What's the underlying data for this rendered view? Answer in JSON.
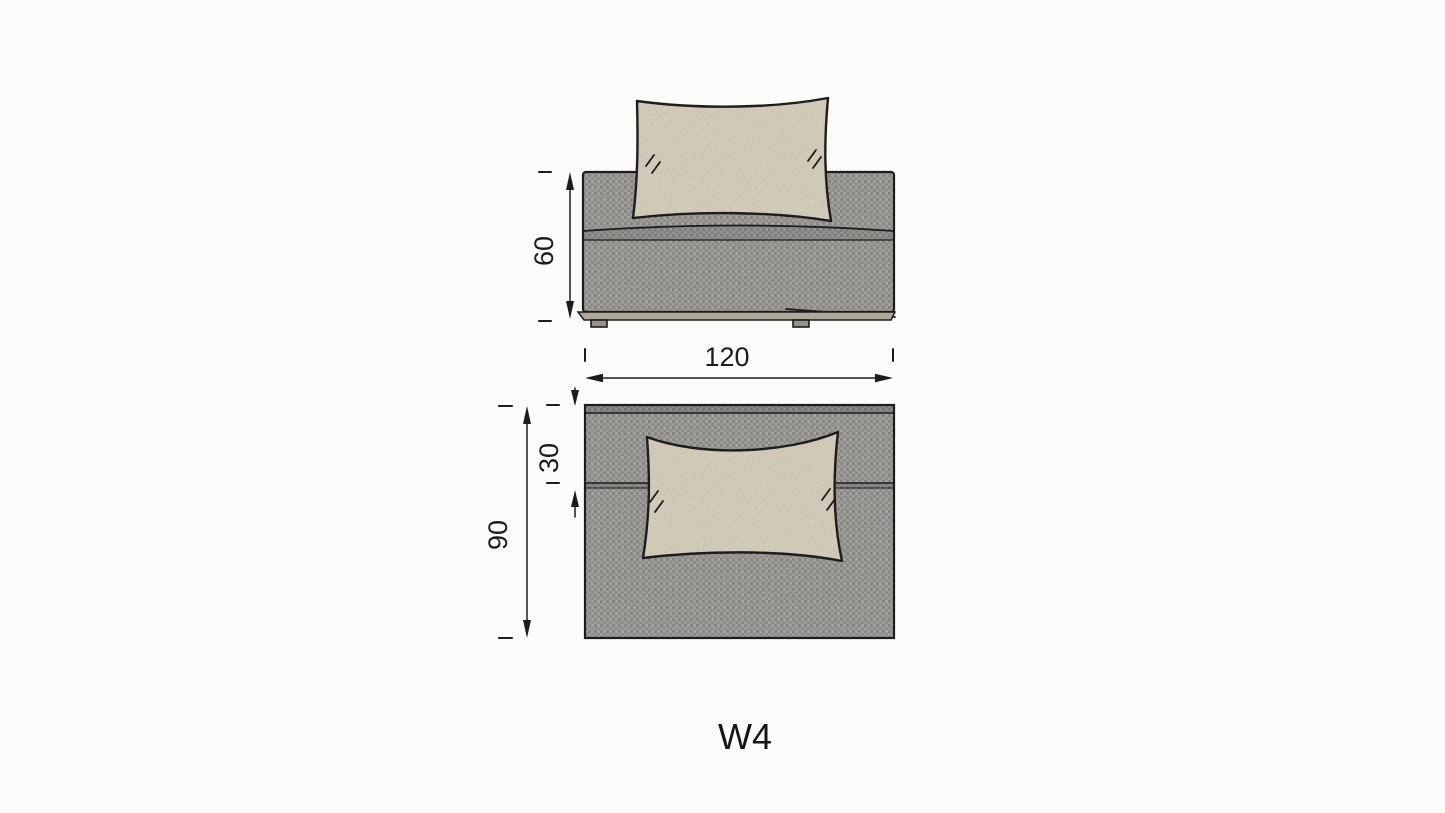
{
  "page": {
    "background": "#fbfbfa"
  },
  "diagram": {
    "module_code": "W4",
    "front_view": {
      "height_dim": "60",
      "width_dim": "120"
    },
    "top_view": {
      "back_depth_dim": "30",
      "depth_dim": "90"
    },
    "colors": {
      "line": "#1c1c1c",
      "fabric_gray": "#b7b5b2",
      "pillow_beige": "#ded5c2",
      "plinth_tan": "#b0a898",
      "foot_gray": "#96928a"
    }
  }
}
